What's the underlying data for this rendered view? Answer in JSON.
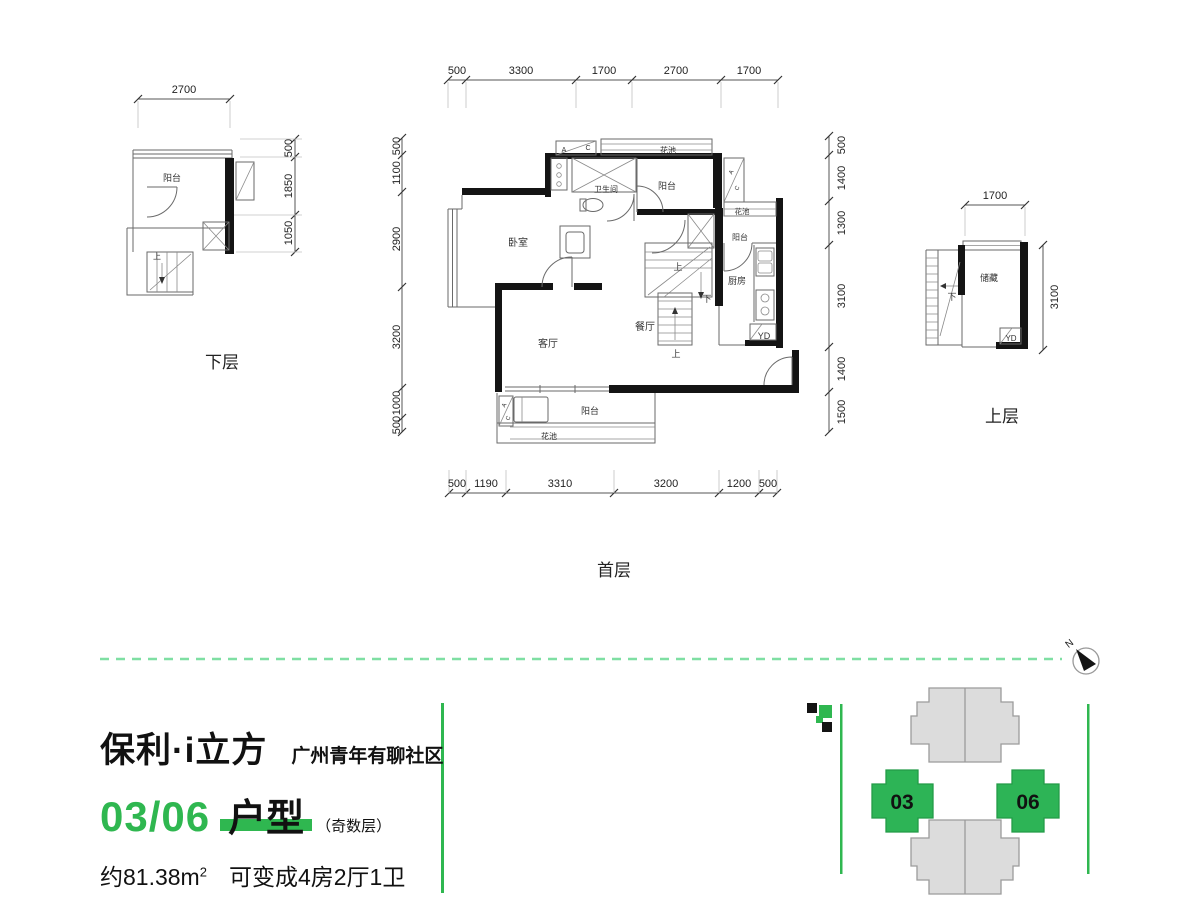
{
  "branding": {
    "title": "保利·i立方",
    "subtitle": "广州青年有聊社区",
    "unit_numbers": "03/06",
    "unit_type_label": "户型",
    "floor_note": "（奇数层）",
    "area_value": "约81.38m",
    "area_superscript": "2",
    "layout_description": "可变成4房2厅1卫"
  },
  "site_plan": {
    "unit_left_label": "03",
    "unit_right_label": "06"
  },
  "compass": {
    "north_label": "N"
  },
  "plans": {
    "lower": {
      "caption": "下层",
      "rooms": {
        "balcony": "阳台",
        "up": "上"
      },
      "dims": {
        "top": [
          "2700"
        ],
        "right": [
          "500",
          "1850",
          "1050"
        ]
      }
    },
    "first": {
      "caption": "首层",
      "rooms": {
        "bedroom": "卧室",
        "living": "客厅",
        "dining": "餐厅",
        "kitchen": "厨房",
        "bathroom": "卫生间",
        "balcony": "阳台",
        "flower_bed": "花池",
        "laundry": "YD",
        "up": "上",
        "down": "下",
        "ac_a": "A",
        "ac_c": "C"
      },
      "dims": {
        "top": [
          "500",
          "3300",
          "1700",
          "2700",
          "1700"
        ],
        "bottom": [
          "500",
          "1190",
          "3310",
          "3200",
          "1200",
          "500"
        ],
        "left": [
          "500",
          "1100",
          "2900",
          "3200",
          "1000",
          "500"
        ],
        "right": [
          "500",
          "1400",
          "1300",
          "3100",
          "1400",
          "1500"
        ]
      }
    },
    "upper": {
      "caption": "上层",
      "rooms": {
        "storage": "储藏",
        "laundry": "YD",
        "down": "下"
      },
      "dims": {
        "top": [
          "1700"
        ],
        "right": [
          "3100"
        ]
      }
    }
  },
  "colors": {
    "accent_green": "#2fb750",
    "site_green": "#2db456",
    "divider_green": "#7fdfa3",
    "wall_black": "#141414"
  }
}
